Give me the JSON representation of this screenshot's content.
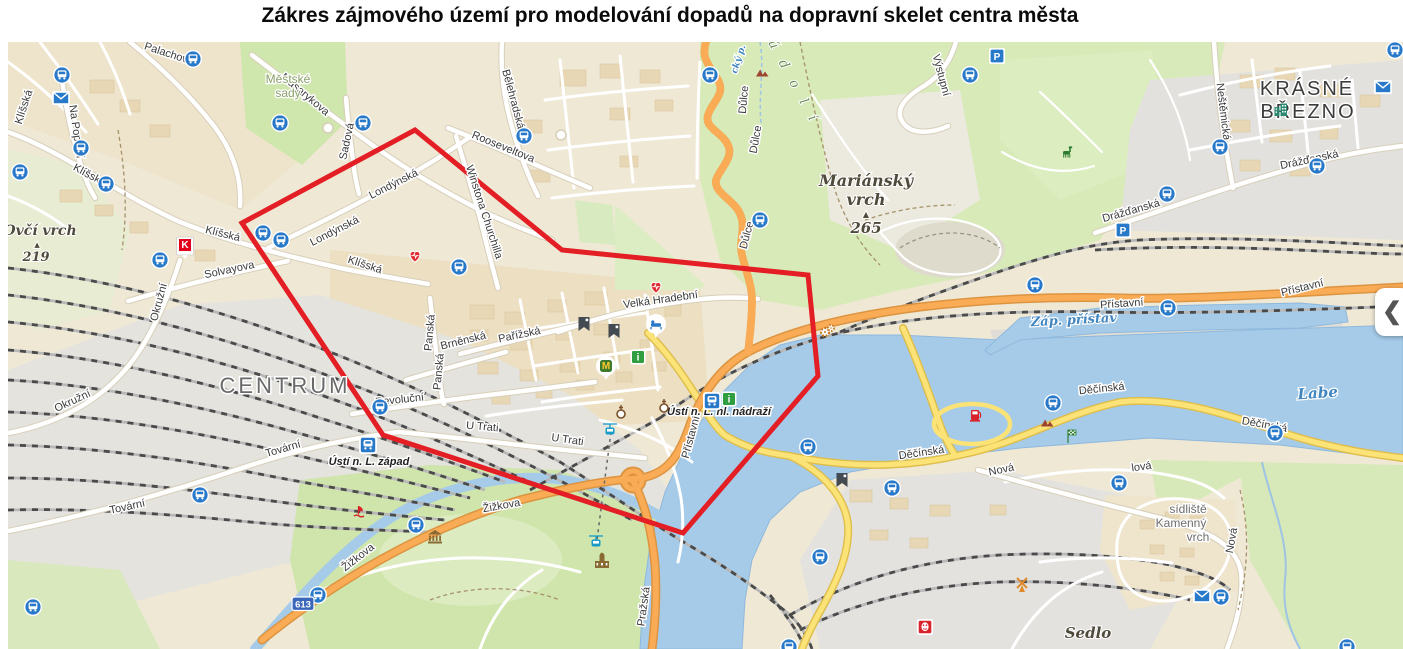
{
  "title": "Zákres zájmového území pro modelování dopadů na dopravní skelet centra města",
  "panel": {
    "chevron": "❮"
  },
  "theme": {
    "polygon_red": "#e31e24",
    "water_blue": "#a5cbe9",
    "road_orange": "#f9ab55",
    "road_yellow": "#fbe377",
    "green": "#d2e7ae",
    "rail_gray": "#e4e3de",
    "transit_blue": "#2879c9"
  },
  "map": {
    "polygon": {
      "color": "#e31e24",
      "points": [
        [
          242,
          223
        ],
        [
          415,
          130
        ],
        [
          562,
          250
        ],
        [
          808,
          275
        ],
        [
          818,
          376
        ],
        [
          683,
          533
        ],
        [
          383,
          435
        ]
      ]
    },
    "street_labels": [
      [
        "Palachova",
        168,
        57,
        18
      ],
      [
        "Masarykova",
        303,
        97,
        40
      ],
      [
        "Sadová",
        350,
        142,
        -78
      ],
      [
        "Klíšská",
        27,
        108,
        -72
      ],
      [
        "Klíšská",
        88,
        178,
        28
      ],
      [
        "Klíšská",
        222,
        237,
        14
      ],
      [
        "Klíšská",
        364,
        268,
        18
      ],
      [
        "Na Popluží",
        73,
        132,
        82
      ],
      [
        "Solvayova",
        230,
        273,
        -12
      ],
      [
        "Okružní",
        162,
        303,
        -75
      ],
      [
        "Okružní",
        74,
        404,
        -25
      ],
      [
        "Tovární",
        128,
        510,
        -12
      ],
      [
        "Tovární",
        284,
        452,
        -16
      ],
      [
        "Revoluční",
        400,
        403,
        -6
      ],
      [
        "U Trati",
        482,
        430,
        5
      ],
      [
        "U Trati",
        567,
        443,
        8
      ],
      [
        "Panská",
        433,
        333,
        -85
      ],
      [
        "Panská",
        442,
        372,
        -85
      ],
      [
        "Brněnská",
        464,
        344,
        -14
      ],
      [
        "Pařížská",
        520,
        338,
        -12
      ],
      [
        "Londýnská",
        336,
        234,
        -27
      ],
      [
        "Londýnská",
        395,
        187,
        -27
      ],
      [
        "Winstona Churchilla",
        481,
        213,
        72
      ],
      [
        "Rooseveltova",
        502,
        150,
        22
      ],
      [
        "Bělehradská",
        510,
        100,
        75
      ],
      [
        "Velká Hradební",
        661,
        303,
        -8
      ],
      [
        "Důlce",
        747,
        100,
        -85
      ],
      [
        "Důlce",
        759,
        140,
        -80
      ],
      [
        "Důlce",
        750,
        236,
        -75
      ],
      [
        "Výstupní",
        938,
        76,
        75
      ],
      [
        "Žižkova",
        502,
        509,
        -10
      ],
      [
        "Žižkova",
        360,
        560,
        -38
      ],
      [
        "Pražská",
        647,
        607,
        -82
      ],
      [
        "Přístavní",
        694,
        438,
        -75
      ],
      [
        "Přístavní",
        1122,
        307,
        -4
      ],
      [
        "Přístavní",
        1303,
        291,
        -14
      ],
      [
        "Děčínská",
        922,
        456,
        -8
      ],
      [
        "Děčínská",
        1102,
        392,
        -6
      ],
      [
        "Děčínská",
        1264,
        428,
        10
      ],
      [
        "Nová",
        1002,
        473,
        -12
      ],
      [
        "Nová",
        1235,
        541,
        -80
      ],
      [
        "Neštěmická",
        1220,
        112,
        83
      ],
      [
        "Drážďanská",
        1132,
        214,
        -16
      ],
      [
        "Drážďanská",
        1310,
        163,
        -12
      ],
      [
        "lová",
        1142,
        470,
        -8
      ]
    ],
    "water_labels": [
      [
        "Labe",
        1318,
        398,
        -4,
        15
      ],
      [
        "Záp. přístav",
        1074,
        324,
        -3,
        13
      ],
      [
        "cký p.",
        741,
        60,
        -72,
        9
      ]
    ],
    "place_labels": [
      {
        "t": "CENTRUM",
        "x": 285,
        "y": 393,
        "cls": "district"
      },
      {
        "t": "KRÁSNÉ",
        "x": 1307,
        "y": 95,
        "cls": "district2"
      },
      {
        "t": "BŘEZNO",
        "x": 1308,
        "y": 118,
        "cls": "district2"
      },
      {
        "t": "Městské",
        "x": 288,
        "y": 83,
        "cls": "park"
      },
      {
        "t": "sady",
        "x": 288,
        "y": 97,
        "cls": "park"
      },
      {
        "t": "Mariánský",
        "x": 866,
        "y": 186,
        "cls": "hill",
        "size": 16
      },
      {
        "t": "vrch",
        "x": 866,
        "y": 205,
        "cls": "hill",
        "size": 16
      },
      {
        "t": "▲",
        "x": 866,
        "y": 217,
        "cls": "hill",
        "size": 8
      },
      {
        "t": "265",
        "x": 866,
        "y": 233,
        "cls": "hill",
        "size": 15
      },
      {
        "t": "Ovčí vrch",
        "x": 40,
        "y": 235,
        "cls": "hill",
        "size": 14
      },
      {
        "t": "▲",
        "x": 37,
        "y": 247,
        "cls": "hill",
        "size": 7
      },
      {
        "t": "219",
        "x": 36,
        "y": 261,
        "cls": "hill",
        "size": 13
      },
      {
        "t": "Sedlo",
        "x": 1088,
        "y": 638,
        "cls": "hill",
        "size": 15
      },
      {
        "t": "ú d o l í",
        "x": 790,
        "y": 84,
        "cls": "valley",
        "rot": 62
      },
      {
        "t": "sídliště",
        "x": 1188,
        "y": 513,
        "cls": "small"
      },
      {
        "t": "Kamenný",
        "x": 1181,
        "y": 527,
        "cls": "small"
      },
      {
        "t": "vrch",
        "x": 1198,
        "y": 541,
        "cls": "small"
      },
      {
        "t": "Ústí n. L. západ",
        "x": 369,
        "y": 465,
        "cls": "station"
      },
      {
        "t": "Ústí n. L. hl. nádraží",
        "x": 719,
        "y": 415,
        "cls": "station"
      }
    ],
    "icon_glyphs": {
      "parking": "P",
      "info": "i",
      "mcdonalds": "M",
      "kaufland": "K"
    },
    "road_shield_label": "613",
    "icons": {
      "bus-stop": [
        [
          62,
          75
        ],
        [
          193,
          59
        ],
        [
          81,
          148
        ],
        [
          20,
          172
        ],
        [
          106,
          184
        ],
        [
          160,
          260
        ],
        [
          263,
          233
        ],
        [
          281,
          240
        ],
        [
          280,
          123
        ],
        [
          363,
          123
        ],
        [
          524,
          136
        ],
        [
          459,
          267
        ],
        [
          710,
          75
        ],
        [
          760,
          220
        ],
        [
          970,
          75
        ],
        [
          1220,
          147
        ],
        [
          1167,
          194
        ],
        [
          1317,
          166
        ],
        [
          1395,
          50
        ],
        [
          380,
          407
        ],
        [
          416,
          525
        ],
        [
          318,
          595
        ],
        [
          808,
          447
        ],
        [
          820,
          557
        ],
        [
          1035,
          285
        ],
        [
          1168,
          308
        ],
        [
          1053,
          403
        ],
        [
          1275,
          433
        ],
        [
          1119,
          483
        ],
        [
          1221,
          597
        ],
        [
          1347,
          647
        ],
        [
          789,
          647
        ],
        [
          892,
          488
        ],
        [
          200,
          495
        ],
        [
          33,
          607
        ]
      ],
      "post-office": [
        [
          61,
          98
        ],
        [
          1383,
          87
        ],
        [
          1202,
          596
        ]
      ],
      "parking": [
        [
          997,
          56
        ],
        [
          1123,
          230
        ]
      ],
      "kaufland": [
        [
          185,
          246
        ]
      ],
      "hospital-heart": [
        [
          415,
          257
        ],
        [
          656,
          288
        ]
      ],
      "hotel": [
        [
          656,
          324
        ]
      ],
      "mcdonalds": [
        [
          606,
          366
        ]
      ],
      "info": [
        [
          638,
          357
        ],
        [
          729,
          399
        ]
      ],
      "museum-banner": [
        [
          584,
          324
        ],
        [
          614,
          331
        ],
        [
          842,
          480
        ]
      ],
      "church": [
        [
          621,
          412
        ],
        [
          664,
          406
        ]
      ],
      "museum-building": [
        [
          435,
          537
        ]
      ],
      "castle": [
        [
          602,
          562
        ]
      ],
      "theater": [
        [
          925,
          627
        ]
      ],
      "cable-car": [
        [
          610,
          430
        ],
        [
          596,
          542
        ]
      ],
      "fuel-station": [
        [
          975,
          415
        ]
      ],
      "harbor": [
        [
          359,
          512
        ]
      ],
      "windmill": [
        [
          1022,
          583
        ]
      ],
      "gears": [
        [
          825,
          332
        ]
      ],
      "mountain": [
        [
          1047,
          423
        ],
        [
          762,
          73
        ]
      ],
      "checkered-flag": [
        [
          1068,
          437
        ]
      ],
      "zoo-animal": [
        [
          1067,
          153
        ]
      ],
      "train-station": [
        [
          368,
          445
        ],
        [
          712,
          401
        ]
      ],
      "apartment-building": [
        [
          1281,
          110
        ]
      ],
      "road-shield": [
        [
          303,
          604
        ]
      ]
    }
  }
}
